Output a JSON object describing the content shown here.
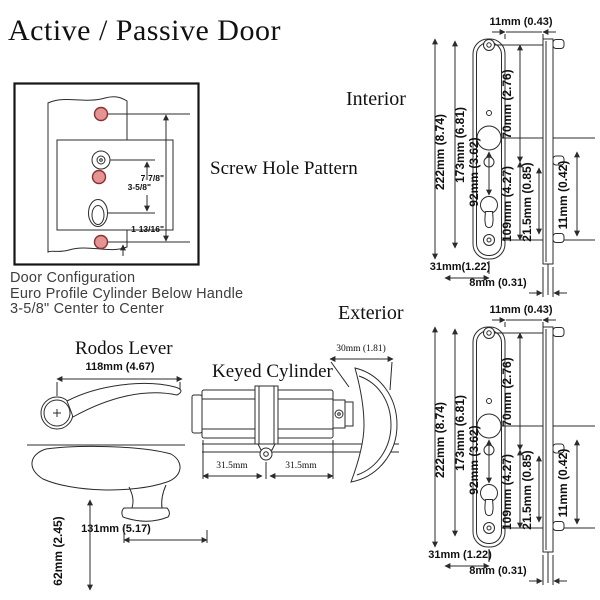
{
  "title": "Active / Passive Door",
  "screw_hole_pattern": {
    "label": "Screw Hole Pattern",
    "dim_total": "7-7/8\"",
    "dim_center": "3-5/8\"",
    "dim_bottom": "1-13/16\""
  },
  "door_configuration": {
    "line1": "Door Configuration",
    "line2": "Euro Profile Cylinder Below Handle",
    "line3": "3-5/8\" Center to Center"
  },
  "interior": {
    "label": "Interior",
    "dims": {
      "top_width": "11mm (0.43)",
      "overall_height": "222mm (8.74)",
      "plate_height": "173mm (6.81)",
      "screw_spacing_top": "70mm (2.76)",
      "handle_to_cylinder": "92mm (3.62)",
      "screw_spacing_bottom": "109mm (4.27)",
      "cylinder_offset": "21.5mm (0.85)",
      "side_depth": "11mm (0.42)",
      "plate_width": "31mm(1.22)",
      "edge_thickness": "8mm (0.31)"
    }
  },
  "exterior": {
    "label": "Exterior",
    "dims": {
      "top_width": "11mm (0.43)",
      "overall_height": "222mm (8.74)",
      "plate_height": "173mm (6.81)",
      "screw_spacing_top": "70mm (2.76)",
      "handle_to_cylinder": "92mm (3.62)",
      "screw_spacing_bottom": "109mm (4.27)",
      "cylinder_offset": "21.5mm (0.85)",
      "side_depth": "11mm (0.42)",
      "plate_width": "31mm (1.22)",
      "edge_thickness": "8mm (0.31)"
    }
  },
  "rodos_lever": {
    "label": "Rodos Lever",
    "dims": {
      "top_length": "118mm (4.67)",
      "side_length": "131mm (5.17)",
      "height": "62mm (2.45)"
    }
  },
  "keyed_cylinder": {
    "label": "Keyed Cylinder",
    "dims": {
      "thumbturn_width": "30mm (1.81)",
      "left_half": "31.5mm",
      "right_half": "31.5mm"
    }
  },
  "colors": {
    "line": "#2b2b2b",
    "screw_hole_fill": "#e59494",
    "screw_hole_stroke": "#8b3030"
  }
}
